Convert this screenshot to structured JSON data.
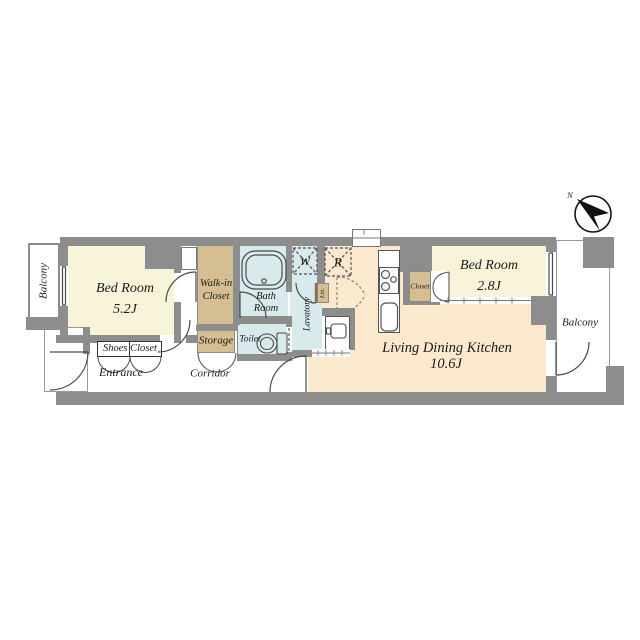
{
  "compass": {
    "label": "N"
  },
  "rooms": {
    "balcony_left": {
      "label": "Balcony"
    },
    "bedroom1": {
      "name": "Bed Room",
      "size": "5.2J"
    },
    "walk_in_closet": {
      "name_line1": "Walk-in",
      "name_line2": "Closet"
    },
    "shoes_closet": {
      "label": "Shoes Closet"
    },
    "entrance": {
      "label": "Entrance"
    },
    "corridor": {
      "label": "Corridor"
    },
    "storage": {
      "label": "Storage"
    },
    "bath": {
      "name_line1": "Bath",
      "name_line2": "Room"
    },
    "toilet": {
      "label": "Toilet"
    },
    "lavatory": {
      "label": "Lavatory"
    },
    "linen": {
      "label": "Lin."
    },
    "washer_spot": {
      "label": "W"
    },
    "refrigerator_spot": {
      "label": "R"
    },
    "closet": {
      "label": "Closet"
    },
    "bedroom2": {
      "name": "Bed Room",
      "size": "2.8J"
    },
    "ldk": {
      "name": "Living Dining Kitchen",
      "size": "10.6J"
    },
    "balcony_right": {
      "label": "Balcony"
    }
  },
  "colors": {
    "wall": "#8d8d8d",
    "bedroom_fill": "#f8f4da",
    "ldk_fill": "#fbe9cd",
    "closet_fill": "#d6be93",
    "wet_area_fill": "#d9eaec",
    "balcony_fill": "#ffffff",
    "line": "#4a4a4a"
  }
}
